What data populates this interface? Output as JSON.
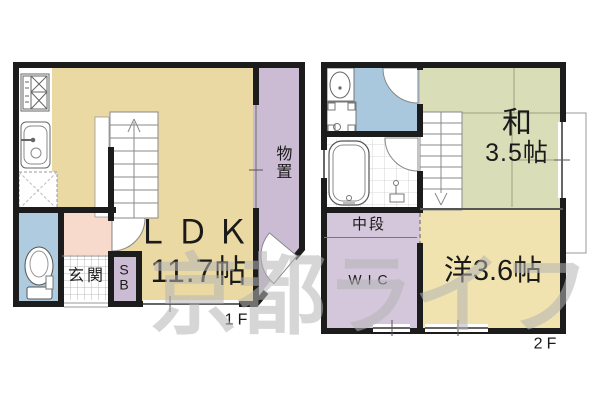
{
  "watermark": "京都ライフ",
  "floor1": {
    "floor_label": "1F",
    "ldk_name": "ＬＤＫ",
    "ldk_size": "11.7帖",
    "genkan": "玄関",
    "shoe_box_line1": "S",
    "shoe_box_line2": "B",
    "storage": "物置"
  },
  "floor2": {
    "floor_label": "2F",
    "washitsu_name": "和",
    "washitsu_size": "3.5帖",
    "youshitsu": "洋3.6帖",
    "chudan": "中段",
    "wic": "WIC"
  },
  "colors": {
    "ldk_floor": "#EBD9A3",
    "western_floor": "#F1E3AF",
    "tatami_floor": "#D9DEB9",
    "storage_purple": "#CBBBD3",
    "closet_purple": "#D4C6DB",
    "toilet_blue": "#AECBE0",
    "washroom_blue": "#A9C8DD",
    "hall_pink": "#F8DACC",
    "wall": "#1C1C1C",
    "watermark_gray": "#B5B5B5"
  }
}
